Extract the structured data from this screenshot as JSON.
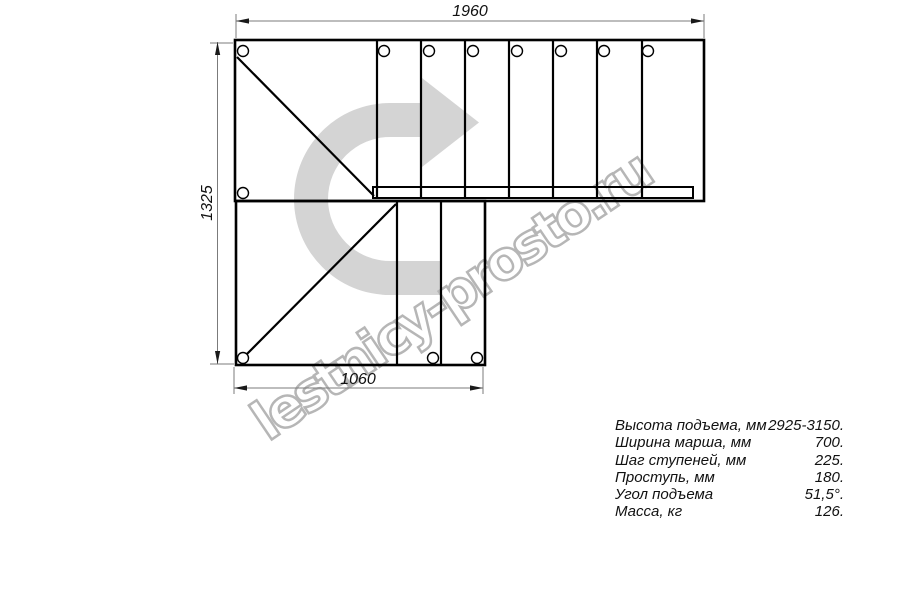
{
  "drawing": {
    "dim_top": "1960",
    "dim_left": "1325",
    "dim_bottom": "1060",
    "line_color": "#000000",
    "dim_line_color": "#7b7b7b"
  },
  "watermark": {
    "text": "lestnicy-prosto.ru",
    "arrow_color": "#d4d4d4",
    "outline_color": "#b6b6b6"
  },
  "specs": {
    "rows": [
      {
        "label": "Высота подъема, мм",
        "value": "2925-3150."
      },
      {
        "label": "Ширина марша, мм",
        "value": "700."
      },
      {
        "label": "Шаг ступеней, мм",
        "value": "225."
      },
      {
        "label": "Проступь, мм",
        "value": "180."
      },
      {
        "label": "Угол подъема",
        "value": "51,5°."
      },
      {
        "label": "Масса, кг",
        "value": "126."
      }
    ]
  }
}
